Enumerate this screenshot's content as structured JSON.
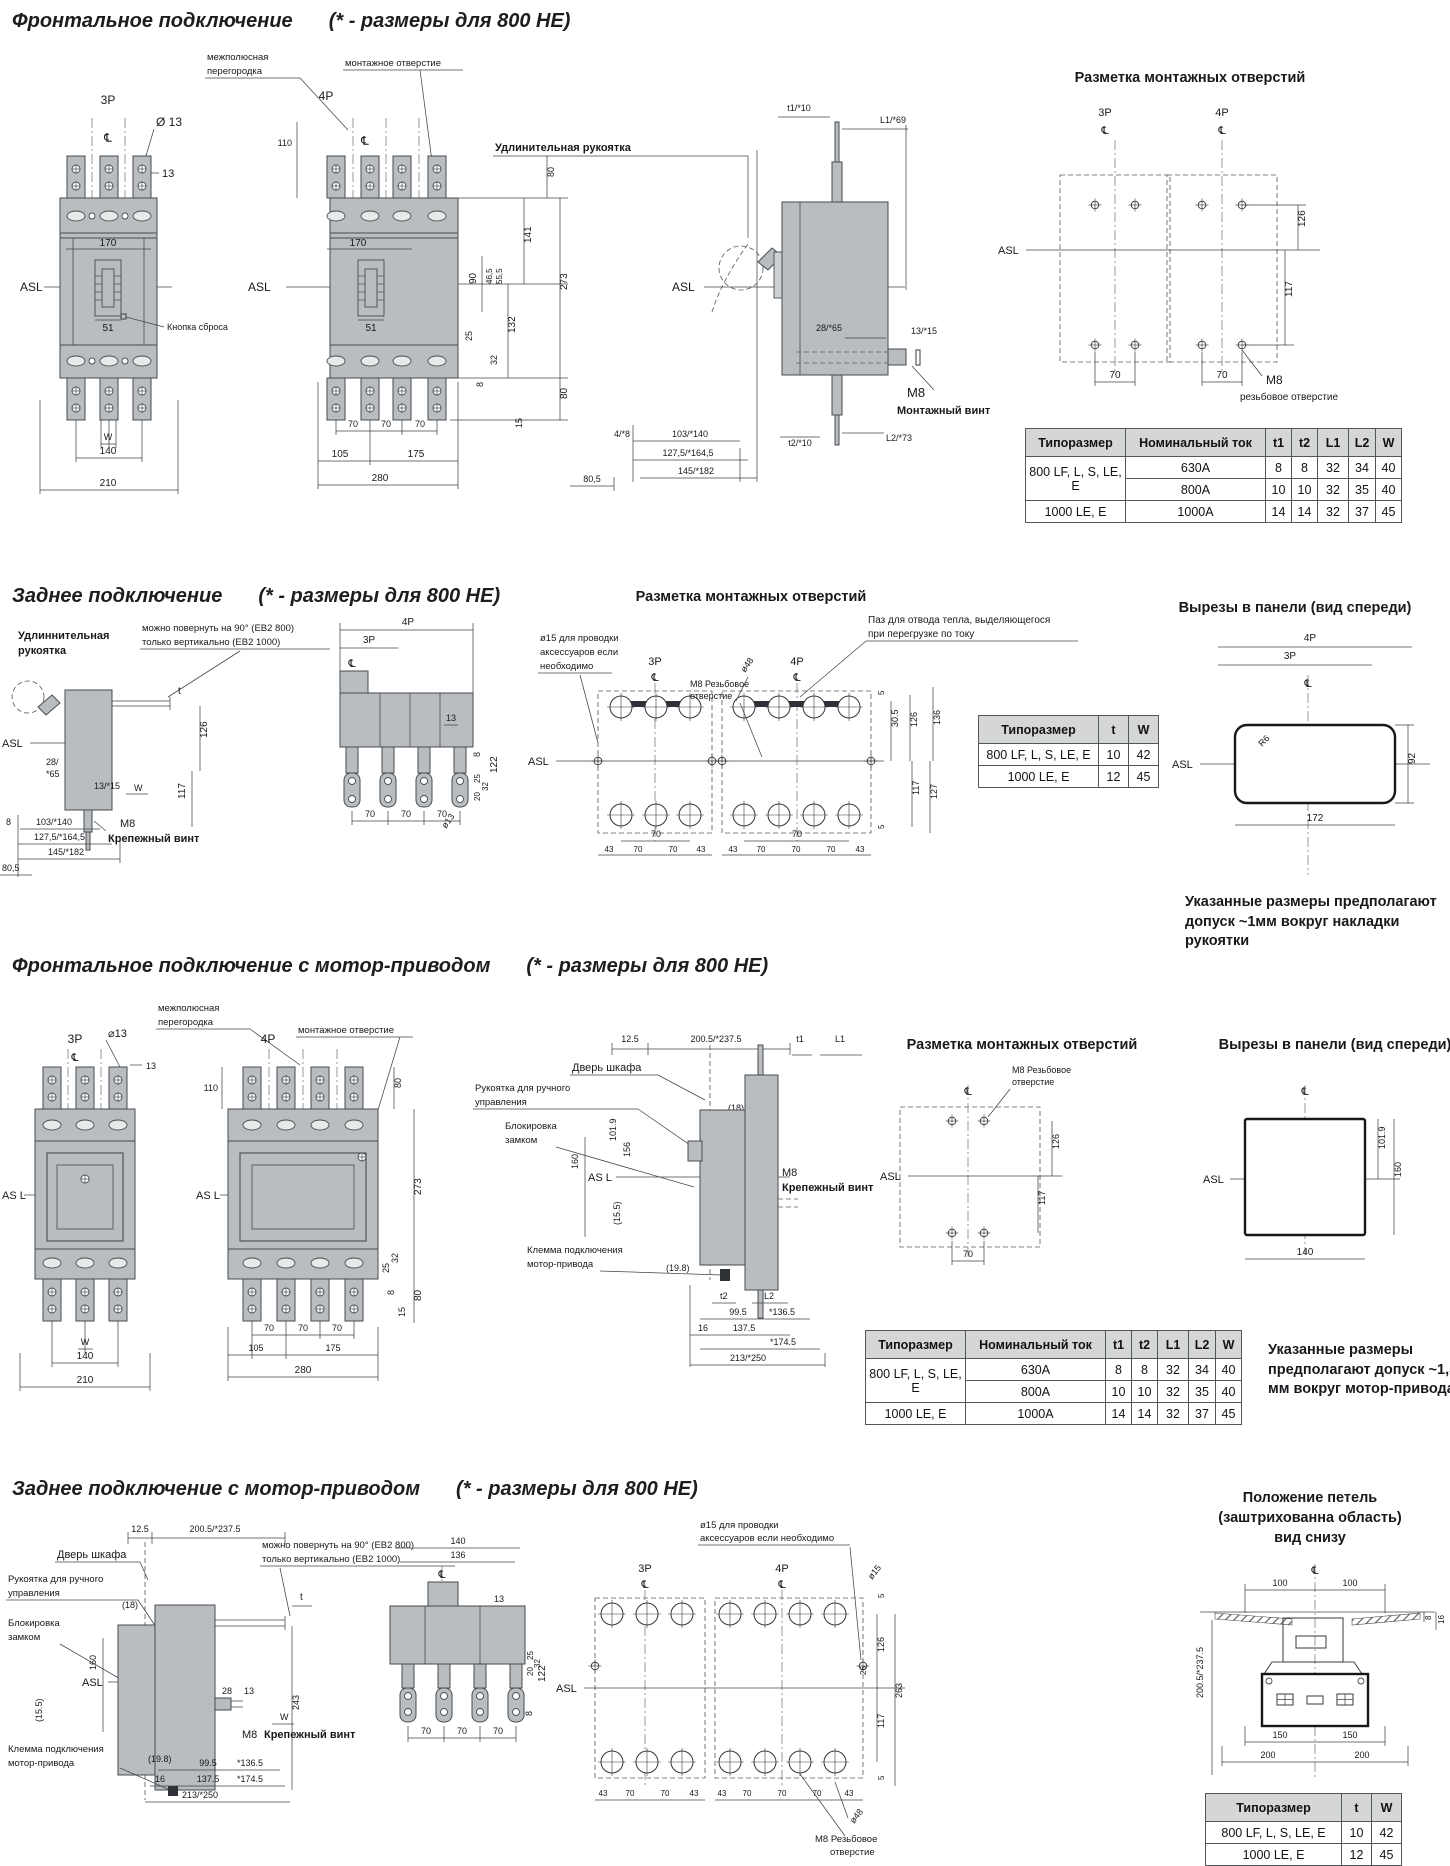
{
  "c": {
    "asl": "ASL",
    "asl2": "AS L",
    "cl": "℄",
    "p3": "3P",
    "p4": "4P",
    "d70": "70",
    "d43": "43",
    "d126": "126",
    "d117": "117"
  },
  "s1": {
    "title": "Фронтальное подключение",
    "note": "(* - размеры для 800 НЕ)",
    "f3": {
      "dia": "Ø 13",
      "w13": "13",
      "d170": "170",
      "d51": "51",
      "reset": "Кнопка сброса",
      "w": "W",
      "d140": "140",
      "d210": "210"
    },
    "f4": {
      "bar1": "межполюсная",
      "bar2": "перегородка",
      "mount": "монтажное отверстие",
      "d110": "110",
      "d105": "105",
      "d175": "175",
      "d280": "280",
      "d80t": "80",
      "d141": "141",
      "d90": "90",
      "d465": "46,5",
      "d555": "55,5",
      "d273": "273",
      "d132": "132",
      "d25": "25",
      "d32": "32",
      "d8": "8",
      "d80b": "80",
      "d15": "15"
    },
    "sd": {
      "handle": "Удлинительная рукоятка",
      "t1": "t1/*10",
      "l1": "L1/*69",
      "d28": "28/*65",
      "d13": "13/*15",
      "m8": "M8",
      "screw": "Монтажный винт",
      "t2": "t2/*10",
      "l2": "L2/*73",
      "d4": "4/*8",
      "d103": "103/*140",
      "d127": "127,5/*164,5",
      "d145": "145/*182",
      "d805": "80,5"
    },
    "hl": {
      "sub": "Разметка монтажных отверстий",
      "m8": "M8",
      "thread": "резьбовое отверстие"
    },
    "table": {
      "h": [
        "Типоразмер",
        "Номинальный ток",
        "t1",
        "t2",
        "L1",
        "L2",
        "W"
      ],
      "g1": {
        "size": "800 LF, L, S, LE, E",
        "r1": [
          "630A",
          "8",
          "8",
          "32",
          "34",
          "40"
        ],
        "r2": [
          "800A",
          "10",
          "10",
          "32",
          "35",
          "40"
        ]
      },
      "g2": {
        "size": "1000 LE, E",
        "r": [
          "1000A",
          "14",
          "14",
          "32",
          "37",
          "45"
        ]
      }
    }
  },
  "s2": {
    "title": "Заднее подключение",
    "note": "(* - размеры для 800 НЕ)",
    "sd": {
      "h1": "Удлиннительная",
      "h2": "рукоятка",
      "rot1": "можно повернуть на 90° (EB2 800)",
      "rot2": "только вертикально (EB2 1000)",
      "t": "t",
      "d28a": "28/",
      "d28b": "*65",
      "d13": "13/*15",
      "w": "W",
      "m8": "M8",
      "screw": "Крепежный винт",
      "d8": "8",
      "d103": "103/*140",
      "d127": "127,5/*164,5",
      "d145": "145/*182",
      "d805": "80,5"
    },
    "rr": {
      "d13": "13",
      "d122": "122",
      "d8": "8",
      "d20": "20",
      "d32": "32",
      "d25": "25",
      "dia": "ø13"
    },
    "hl": {
      "sub": "Разметка монтажных отверстий",
      "acc1": "ø15 для проводки",
      "acc2": "аксессуаров если",
      "acc3": "необходимо",
      "slot1": "Паз для отвода тепла, выделяющегося",
      "slot2": "при перегрузке по току",
      "d48": "ø48",
      "d5": "5",
      "d305": "30.5",
      "d136": "136",
      "d127": "127",
      "m8a": "M8 Резьбовое",
      "m8b": "отверстие"
    },
    "table": {
      "h": [
        "Типоразмер",
        "t",
        "W"
      ],
      "r1": [
        "800 LF, L, S, LE, E",
        "10",
        "42"
      ],
      "r2": [
        "1000 LE, E",
        "12",
        "45"
      ]
    },
    "ct": {
      "sub": "Вырезы в панели (вид спереди)",
      "r6": "R6",
      "d92": "92",
      "d172": "172"
    },
    "note2": "Указанные размеры предполагают допуск ~1мм вокруг накладки рукоятки"
  },
  "s3": {
    "title": "Фронтальное подключение с мотор-приводом",
    "note": "(* - размеры для 800 НЕ)",
    "f3": {
      "dia": "⌀13",
      "d13": "13",
      "w": "W",
      "d140": "140",
      "d210": "210"
    },
    "f4": {
      "bar1": "межполюсная",
      "bar2": "перегородка",
      "mount": "монтажное отверстие",
      "d110": "110",
      "d80t": "80",
      "d273": "273",
      "d32": "32",
      "d25": "25",
      "d8": "8",
      "d80b": "80",
      "d15": "15",
      "d105": "105",
      "d175": "175",
      "d280": "280"
    },
    "sd": {
      "d125": "12.5",
      "d200": "200.5/*237.5",
      "t1": "t1",
      "l1": "L1",
      "door": "Дверь шкафа",
      "h1": "Рукоятка для ручного",
      "h2": "управления",
      "d18": "(18)",
      "lk1": "Блокировка",
      "lk2": "замком",
      "d101": "101.9",
      "d156": "156",
      "d160": "160",
      "d155": "(15.5)",
      "tm1": "Клемма подключения",
      "tm2": "мотор-привода",
      "d198": "(19.8)",
      "m8": "M8",
      "screw": "Крепежный винт",
      "t2": "t2",
      "l2": "L2",
      "d995": "99.5",
      "d1365": "*136.5",
      "d16": "16",
      "d1375": "137.5",
      "d1745": "*174.5",
      "d213": "213/*250"
    },
    "hl": {
      "sub": "Разметка монтажных отверстий",
      "m8a": "M8  Резьбовое",
      "m8b": "отверстие"
    },
    "ct": {
      "sub": "Вырезы в панели (вид спереди)",
      "d101": "101.9",
      "d160": "160",
      "d140": "140"
    },
    "note2": "Указанные размеры предполагают допуск ~1,5 мм вокруг мотор-привода"
  },
  "s4": {
    "title": "Заднее подключение с мотор-приводом",
    "note": "(* - размеры для 800 НЕ)",
    "sd": {
      "d125": "12.5",
      "d200": "200.5/*237.5",
      "door": "Дверь шкафа",
      "rot1": "можно повернуть на 90° (EB2 800)",
      "rot2": "только вертикально (EB2 1000)",
      "h1": "Рукоятка для ручного",
      "h2": "управления",
      "d18": "(18)",
      "t": "t",
      "lk1": "Блокировка",
      "lk2": "замком",
      "d101": "101.9",
      "d156": "156",
      "d160": "160",
      "d155": "(15.5)",
      "d28": "28",
      "d13": "13",
      "w": "W",
      "m8": "M8",
      "screw": "Крепежный винт",
      "tm1": "Клемма подключения",
      "tm2": "мотор-привода",
      "d198": "(19.8)",
      "d16": "16",
      "d995": "99.5",
      "d1365": "*136.5",
      "d1375": "137.5",
      "d1745": "*174.5",
      "d213": "213/*250",
      "d243": "243"
    },
    "rr": {
      "d140": "140",
      "d136": "136",
      "d13": "13",
      "d122": "122",
      "d8": "8",
      "d20": "20",
      "d32": "32",
      "d25": "25"
    },
    "hl": {
      "acc1": "ø15 для проводки",
      "acc2": "аксессуаров если необходимо",
      "d15": "ø15",
      "d5a": "5",
      "d263": "263",
      "d26": "26",
      "d5b": "5",
      "d48": "ø48",
      "m8a": "M8 Резьбовое",
      "m8b": "отверстие"
    },
    "hg": {
      "sub1": "Положение петель",
      "sub2": "(заштрихованна область)",
      "sub3": "вид снизу",
      "d100": "100",
      "d8": "8",
      "d16": "16",
      "d200": "200.5/*237.5",
      "d150": "150",
      "d200b": "200"
    }
  }
}
